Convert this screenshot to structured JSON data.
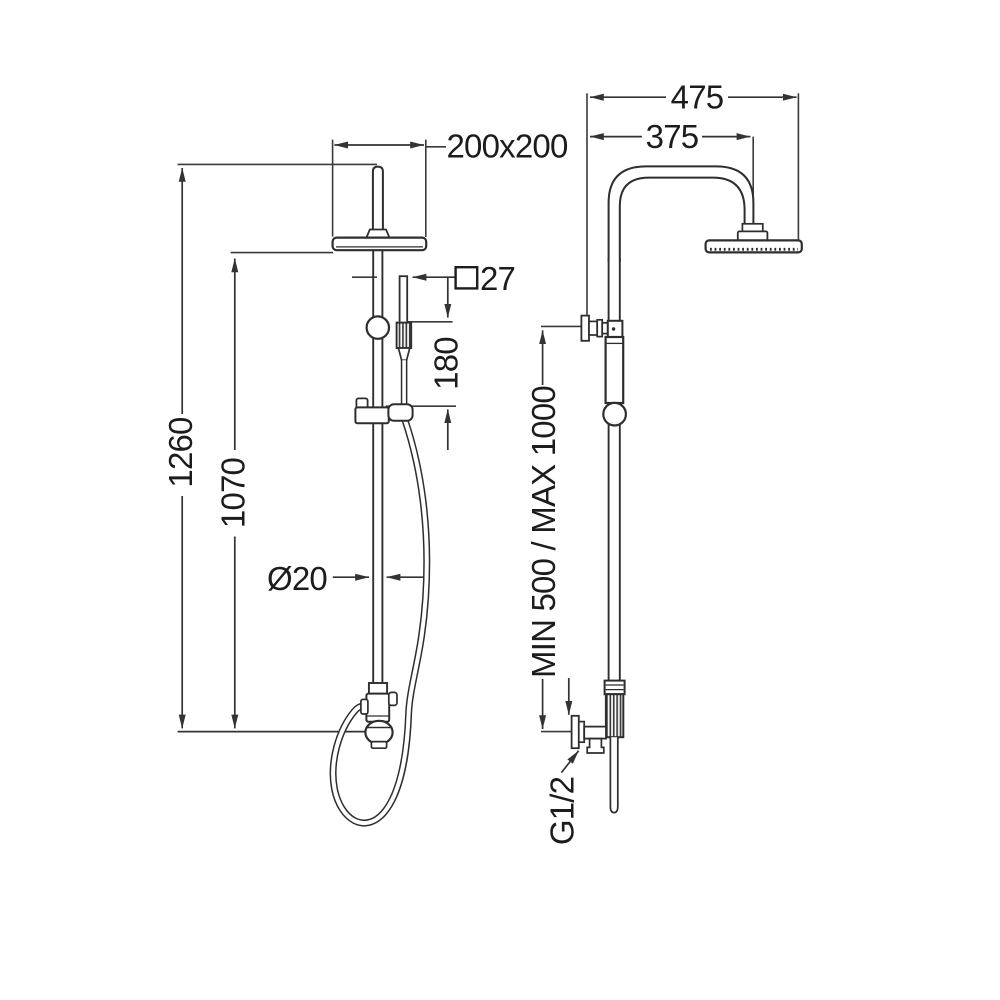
{
  "drawing": {
    "type": "technical-dimension-drawing",
    "subject": "shower column with overhead rain head and handshower",
    "views": [
      "front-view",
      "side-view"
    ]
  },
  "labels": {
    "head_size": "200x200",
    "handle_square": "27",
    "handshower_length": "180",
    "total_height": "1260",
    "head_underside_height": "1070",
    "column_diameter": "Ø20",
    "arm_overall": "475",
    "arm_projection": "375",
    "riser_adjust": "MIN 500 / MAX 1000",
    "inlet_thread": "G1/2"
  },
  "icons": {
    "square_symbol": "square cross-section symbol before 27"
  },
  "colors": {
    "background": "#ffffff",
    "line": "#2e2e2e",
    "dimension_line": "#333333",
    "text": "#1c1c1c"
  }
}
